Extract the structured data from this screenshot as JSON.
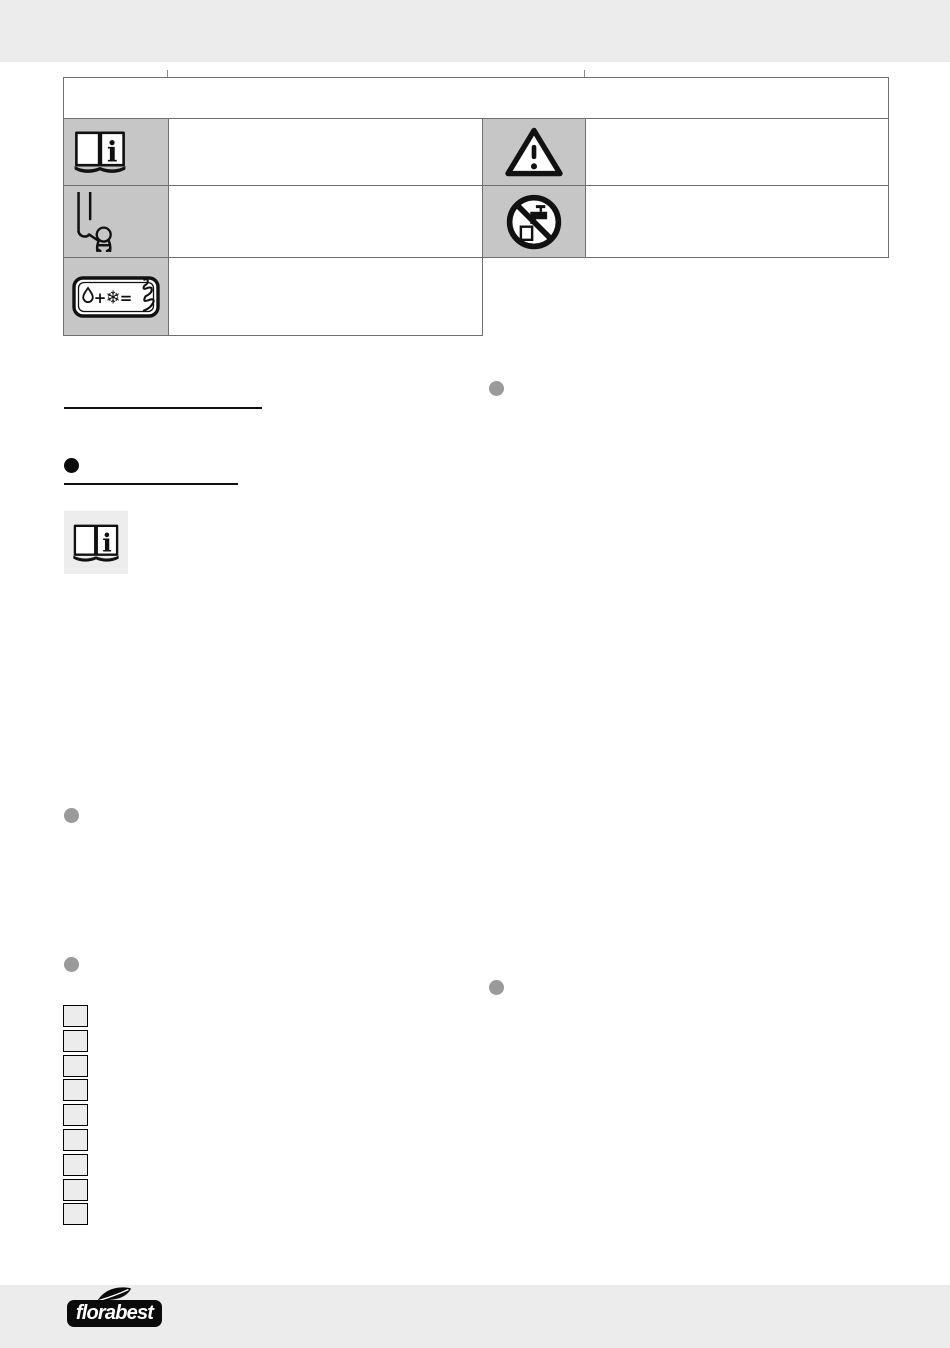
{
  "page": {
    "background_color": "#ffffff",
    "band_color": "#ececec"
  },
  "symbols_table": {
    "header_text": "",
    "border_color": "#6f6f6f",
    "icon_cell_bg": "#c6c6c6",
    "rows": [
      {
        "left": {
          "icon": "open-book-info-icon",
          "text": ""
        },
        "right": {
          "icon": "warning-triangle-icon",
          "text": ""
        }
      },
      {
        "left": {
          "icon": "keep-children-away-icon",
          "text": ""
        },
        "right": {
          "icon": "no-drinking-water-icon",
          "text": ""
        }
      },
      {
        "left": {
          "icon": "frost-warning-icon",
          "text": ""
        }
      }
    ]
  },
  "content": {
    "heading_rule_1": {
      "text": ""
    },
    "section_heading": {
      "bullet_color": "#0b0b0b",
      "text": ""
    },
    "inline_note_icon": "open-book-info-icon",
    "margin_bullet_color": "#9a9a9a",
    "figure_callouts": {
      "count": 9,
      "fill": "#ececec"
    }
  },
  "footer": {
    "brand_logo_text": "florabest",
    "logo_bg": "#0b0b0b",
    "logo_text_color": "#ffffff",
    "leaf_icon": "leaf-icon"
  }
}
